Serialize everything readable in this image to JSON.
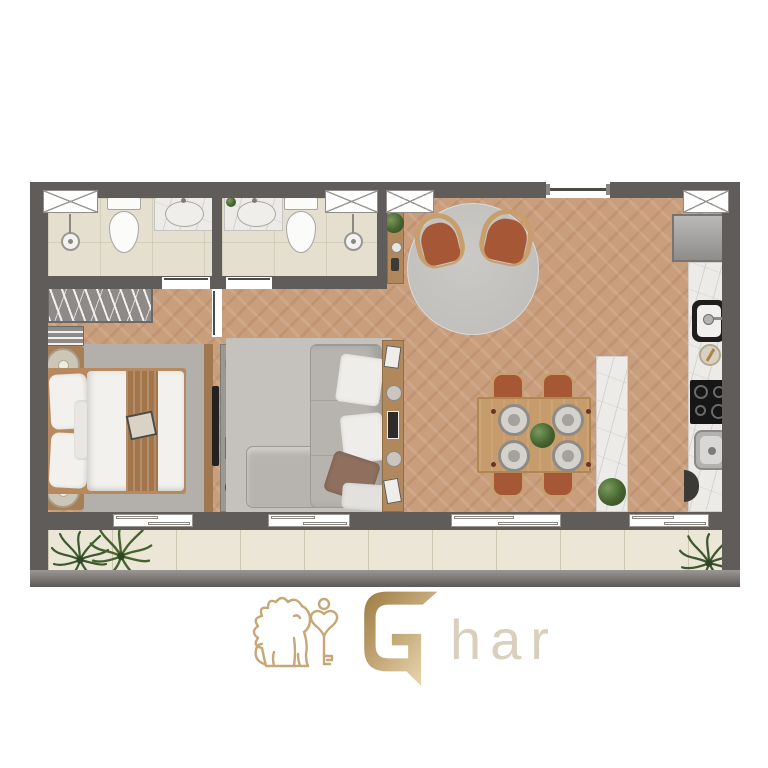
{
  "brand": {
    "name": "Ghar",
    "logo_initial": "G",
    "logo_suffix": "har",
    "gold_dark": "#9e7b42",
    "gold_light": "#f0e3bd",
    "suffix_color": "#d8d0bd"
  },
  "palette": {
    "wall": "#5f5c59",
    "wood_floor": "#c99e7c",
    "bathroom_floor": "#e4dfcf",
    "balcony_floor": "#ebe6d5",
    "marble_counter": "#edebe7",
    "rug_gray": "#b5b2ae",
    "sofa_gray": "#b7b4af",
    "terracotta_chair": "#a65836",
    "furniture_wood": "#c79e6c",
    "bed_linen": "#f2f1ed",
    "bed_runner": "#a2754b",
    "plant_green": "#46632f",
    "appliance_black": "#181818"
  },
  "plan": {
    "type": "apartment-floor-plan-top-view",
    "rooms": [
      {
        "name": "bathroom-1",
        "fixtures": [
          "window",
          "shower-head",
          "toilet",
          "vanity-sink"
        ]
      },
      {
        "name": "bathroom-2",
        "fixtures": [
          "vanity-sink",
          "plant",
          "toilet",
          "window",
          "shower-head"
        ]
      },
      {
        "name": "bedroom",
        "furniture": [
          "open-wardrobe",
          "shelf-unit",
          "nightstand-with-candle",
          "double-bed-with-runner",
          "nightstand-with-candle",
          "area-rug",
          "wall-tv"
        ]
      },
      {
        "name": "living-room",
        "furniture": [
          "media-console",
          "corner-sofa",
          "pillows",
          "area-rug",
          "back-console-with-decor"
        ]
      },
      {
        "name": "entry-lounge",
        "furniture": [
          "round-rug",
          "armchair",
          "armchair",
          "side-console-with-plant",
          "window"
        ]
      },
      {
        "name": "dining-area",
        "furniture": [
          "dining-table",
          "four-chairs",
          "four-place-settings",
          "centerpiece-plant",
          "marble-island-with-plant"
        ]
      },
      {
        "name": "kitchen",
        "furniture": [
          "window",
          "refrigerator",
          "counter-sink",
          "mortar",
          "cooktop-4-burner",
          "second-sink"
        ]
      },
      {
        "name": "balcony",
        "furniture": [
          "potted-plants-left",
          "potted-plant-right",
          "tiled-floor",
          "railing"
        ]
      }
    ],
    "openings": [
      "entry-door-top",
      "bathroom-door-1",
      "bathroom-door-2",
      "bedroom-door",
      "balcony-slider-bedroom",
      "balcony-slider-living",
      "balcony-slider-dining",
      "balcony-slider-kitchen"
    ],
    "window_count": 4
  }
}
